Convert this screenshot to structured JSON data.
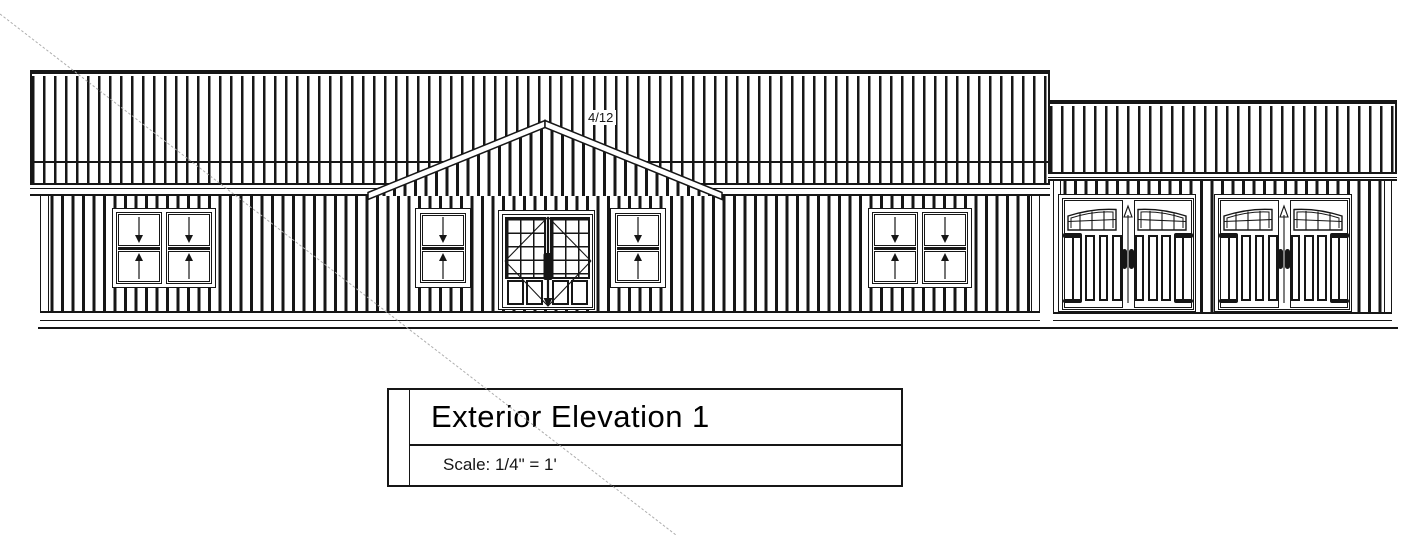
{
  "drawing": {
    "roof_pitch_label": "4/12",
    "title_block": {
      "title": "Exterior Elevation 1",
      "scale": "Scale: 1/4\" = 1'"
    }
  },
  "colors": {
    "ink": "#161616",
    "construction_line": "#adadad",
    "paper": "#ffffff"
  }
}
